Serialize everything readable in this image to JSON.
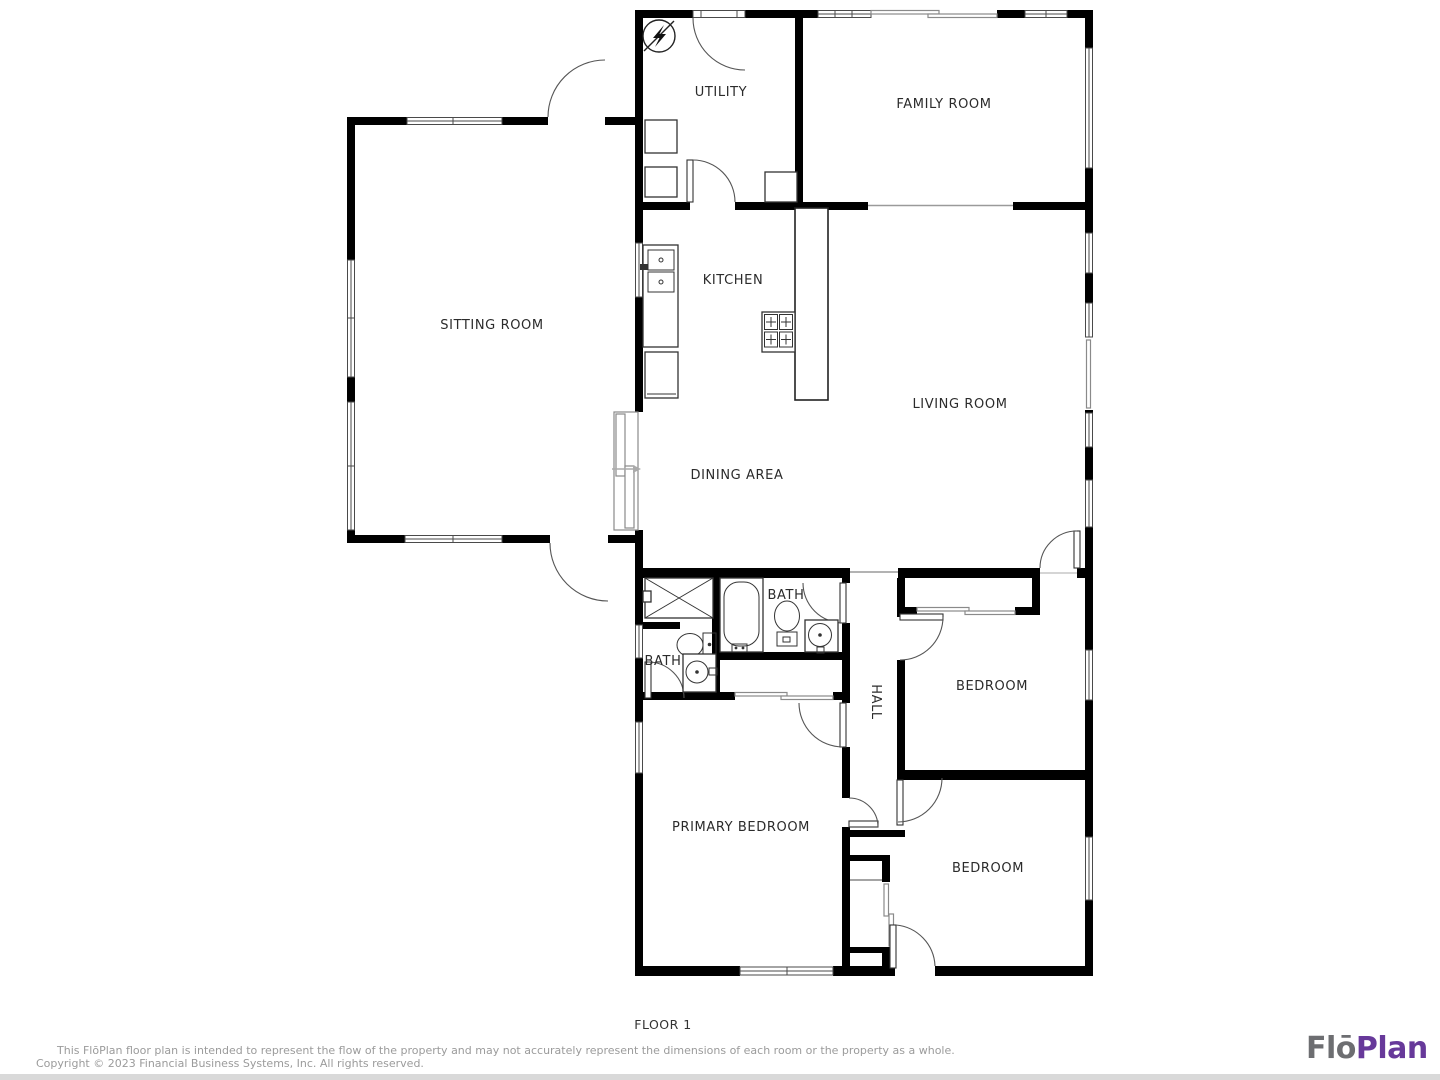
{
  "plan": {
    "rooms": {
      "utility": "UTILITY",
      "family_room": "FAMILY ROOM",
      "sitting_room": "SITTING ROOM",
      "kitchen": "KITCHEN",
      "living_room": "LIVING ROOM",
      "dining_area": "DINING AREA",
      "bath_main": "BATH",
      "bath_ensuite": "BATH",
      "hall": "HALL",
      "bedroom_1": "BEDROOM",
      "primary_bedroom": "PRIMARY BEDROOM",
      "bedroom_2": "BEDROOM"
    },
    "floor_label": "FLOOR 1",
    "colors": {
      "wall": "#000000",
      "label": "#2b2b2b",
      "door_line": "#555555"
    }
  },
  "footer": {
    "disclaimer_line1": "This FlōPlan floor plan is intended to represent the flow of the property and may not accurately represent the dimensions of each room or the property as a whole.",
    "disclaimer_line2": "Copyright © 2023 Financial Business Systems, Inc. All rights reserved.",
    "logo": {
      "part1": "Flō",
      "part2": "Plan",
      "part1_color": "#6d6e71",
      "part2_color": "#67399a"
    }
  }
}
